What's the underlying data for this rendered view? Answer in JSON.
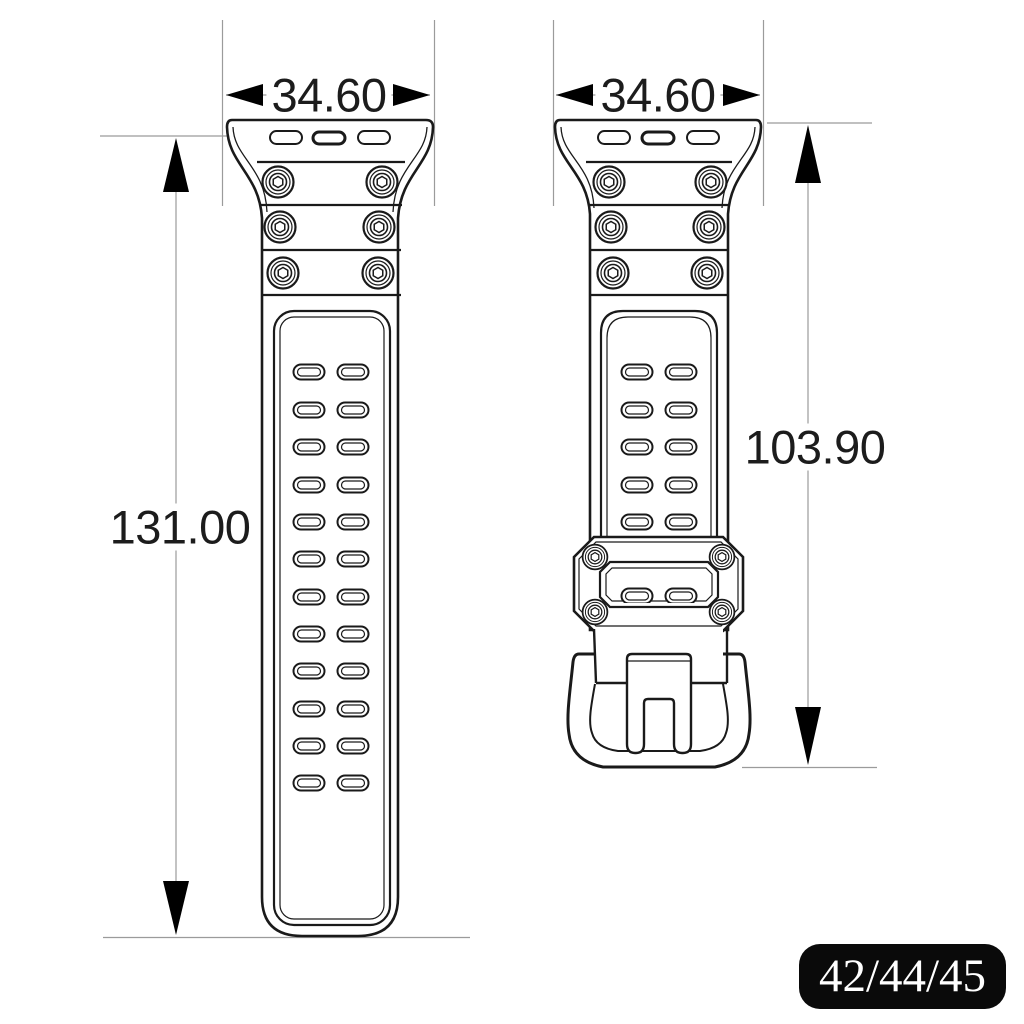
{
  "drawing": {
    "title": "watch strap technical drawing",
    "views": {
      "left": "long strap without buckle",
      "right": "short strap with keeper and buckle"
    },
    "dimensions": {
      "left_width": "34.60",
      "right_width": "34.60",
      "left_length": "131.00",
      "right_length": "103.90"
    },
    "badge": {
      "label": "42/44/45"
    },
    "colors": {
      "background": "#ffffff",
      "line": "#1a1a1a",
      "dimension_line": "#9b9b9b",
      "arrow": "#000000",
      "badge_bg": "#0a0a0a",
      "badge_text": "#ffffff"
    }
  }
}
